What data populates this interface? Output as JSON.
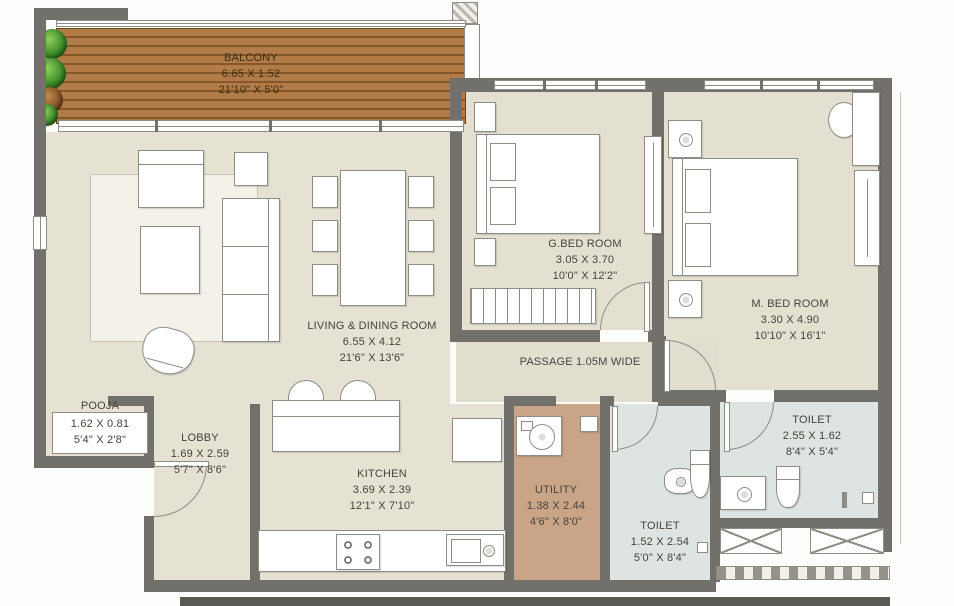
{
  "plan": {
    "type": "apartment-floor-plan",
    "passage": {
      "label": "PASSAGE 1.05M WIDE"
    },
    "rooms": [
      {
        "key": "balcony",
        "name": "BALCONY",
        "metric": "6.65 X 1.52",
        "imperial": "21'10\" X 5'0\""
      },
      {
        "key": "living-dining",
        "name": "LIVING & DINING ROOM",
        "metric": "6.55 X 4.12",
        "imperial": "21'6\" X 13'6\""
      },
      {
        "key": "guest-bedroom",
        "name": "G.BED ROOM",
        "metric": "3.05 X 3.70",
        "imperial": "10'0\" X 12'2\""
      },
      {
        "key": "master-bedroom",
        "name": "M. BED ROOM",
        "metric": "3.30 X 4.90",
        "imperial": "10'10\" X 16'1\""
      },
      {
        "key": "pooja",
        "name": "POOJA",
        "metric": "1.62 X 0.81",
        "imperial": "5'4\" X 2'8\""
      },
      {
        "key": "lobby",
        "name": "LOBBY",
        "metric": "1.69 X 2.59",
        "imperial": "5'7\" X 8'6\""
      },
      {
        "key": "kitchen",
        "name": "KITCHEN",
        "metric": "3.69 X 2.39",
        "imperial": "12'1\" X 7'10\""
      },
      {
        "key": "utility",
        "name": "UTILITY",
        "metric": "1.38 X 2.44",
        "imperial": "4'6\" X 8'0\""
      },
      {
        "key": "toilet-common",
        "name": "TOILET",
        "metric": "1.52 X 2.54",
        "imperial": "5'0\" X 8'4\""
      },
      {
        "key": "toilet-master",
        "name": "TOILET",
        "metric": "2.55 X 1.62",
        "imperial": "8'4\" X 5'4\""
      }
    ],
    "colors": {
      "wall": "#71706a",
      "floor": "#e5e2d3",
      "wood_deck": "#a97140",
      "utility_floor": "#c9a487",
      "toilet_floor": "#dde4e2",
      "plants_green": "#3f8d2b",
      "label_text": "#45433c",
      "balcony_label_text": "#3f2d12"
    }
  }
}
